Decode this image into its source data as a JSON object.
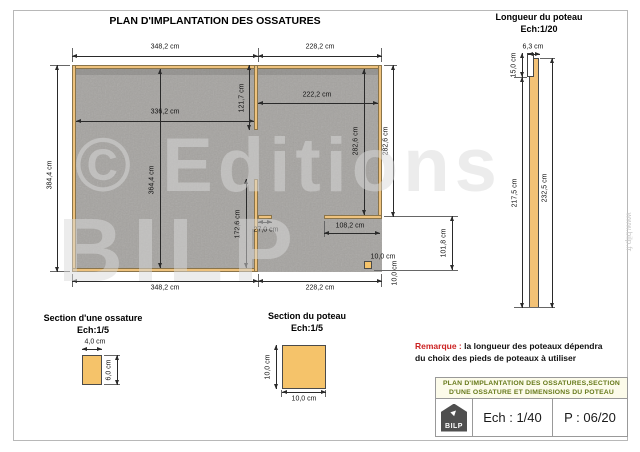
{
  "sheet": {
    "title": "PLAN D'IMPLANTATION DES OSSATURES"
  },
  "plan": {
    "dim_top_left": "348,2 cm",
    "dim_top_right": "228,2 cm",
    "dim_left_height": "384,4 cm",
    "dim_inner_width": "336,2 cm",
    "dim_inner_height": "364,4 cm",
    "dim_mid_wall_upper": "121,7 cm",
    "dim_right_inner_width": "222,2 cm",
    "dim_right_inner_height": "282,6 cm",
    "dim_right_wall": "282,6 cm",
    "dim_mid_wall_lower": "172,6 cm",
    "dim_stub_wall": "27,0 cm",
    "dim_rear_wall": "108,2 cm",
    "dim_post_width": "10,0 cm",
    "dim_post_depth": "10,0 cm",
    "dim_opening": "101,8 cm",
    "dim_bottom_left": "348,2 cm",
    "dim_bottom_right": "228,2 cm"
  },
  "post_elevation": {
    "title": "Longueur du poteau",
    "scale": "Ech:1/20",
    "dim_width": "6,3 cm",
    "dim_notch": "15,0 cm",
    "dim_body": "217,5 cm",
    "dim_total": "232,5 cm"
  },
  "frame_section": {
    "title": "Section d'une ossature",
    "scale": "Ech:1/5",
    "dim_width": "4,0 cm",
    "dim_height": "6,0 cm"
  },
  "post_section": {
    "title": "Section du poteau",
    "scale": "Ech:1/5",
    "dim_width": "10,0 cm",
    "dim_height": "10,0 cm"
  },
  "remark": {
    "label": "Remarque :",
    "line1": "la longueur des poteaux dépendra",
    "line2": "du choix des pieds de poteaux à utiliser"
  },
  "title_block": {
    "line1": "PLAN D'IMPLANTATION DES OSSATURES,SECTION",
    "line2": "D'UNE OSSATURE ET DIMENSIONS DU POTEAU",
    "logo_text": "BILP",
    "scale": "Ech : 1/40",
    "page": "P : 06/20"
  },
  "watermark": {
    "line1": "© Editions",
    "line2": "BILP",
    "site": "www.bilp.fr"
  },
  "colors": {
    "wood": "#EEC27D",
    "wood_light": "#F5C36A",
    "slab_gray": "#A5A3A0",
    "remark_red": "#CC2222",
    "header_green": "#66791A"
  }
}
